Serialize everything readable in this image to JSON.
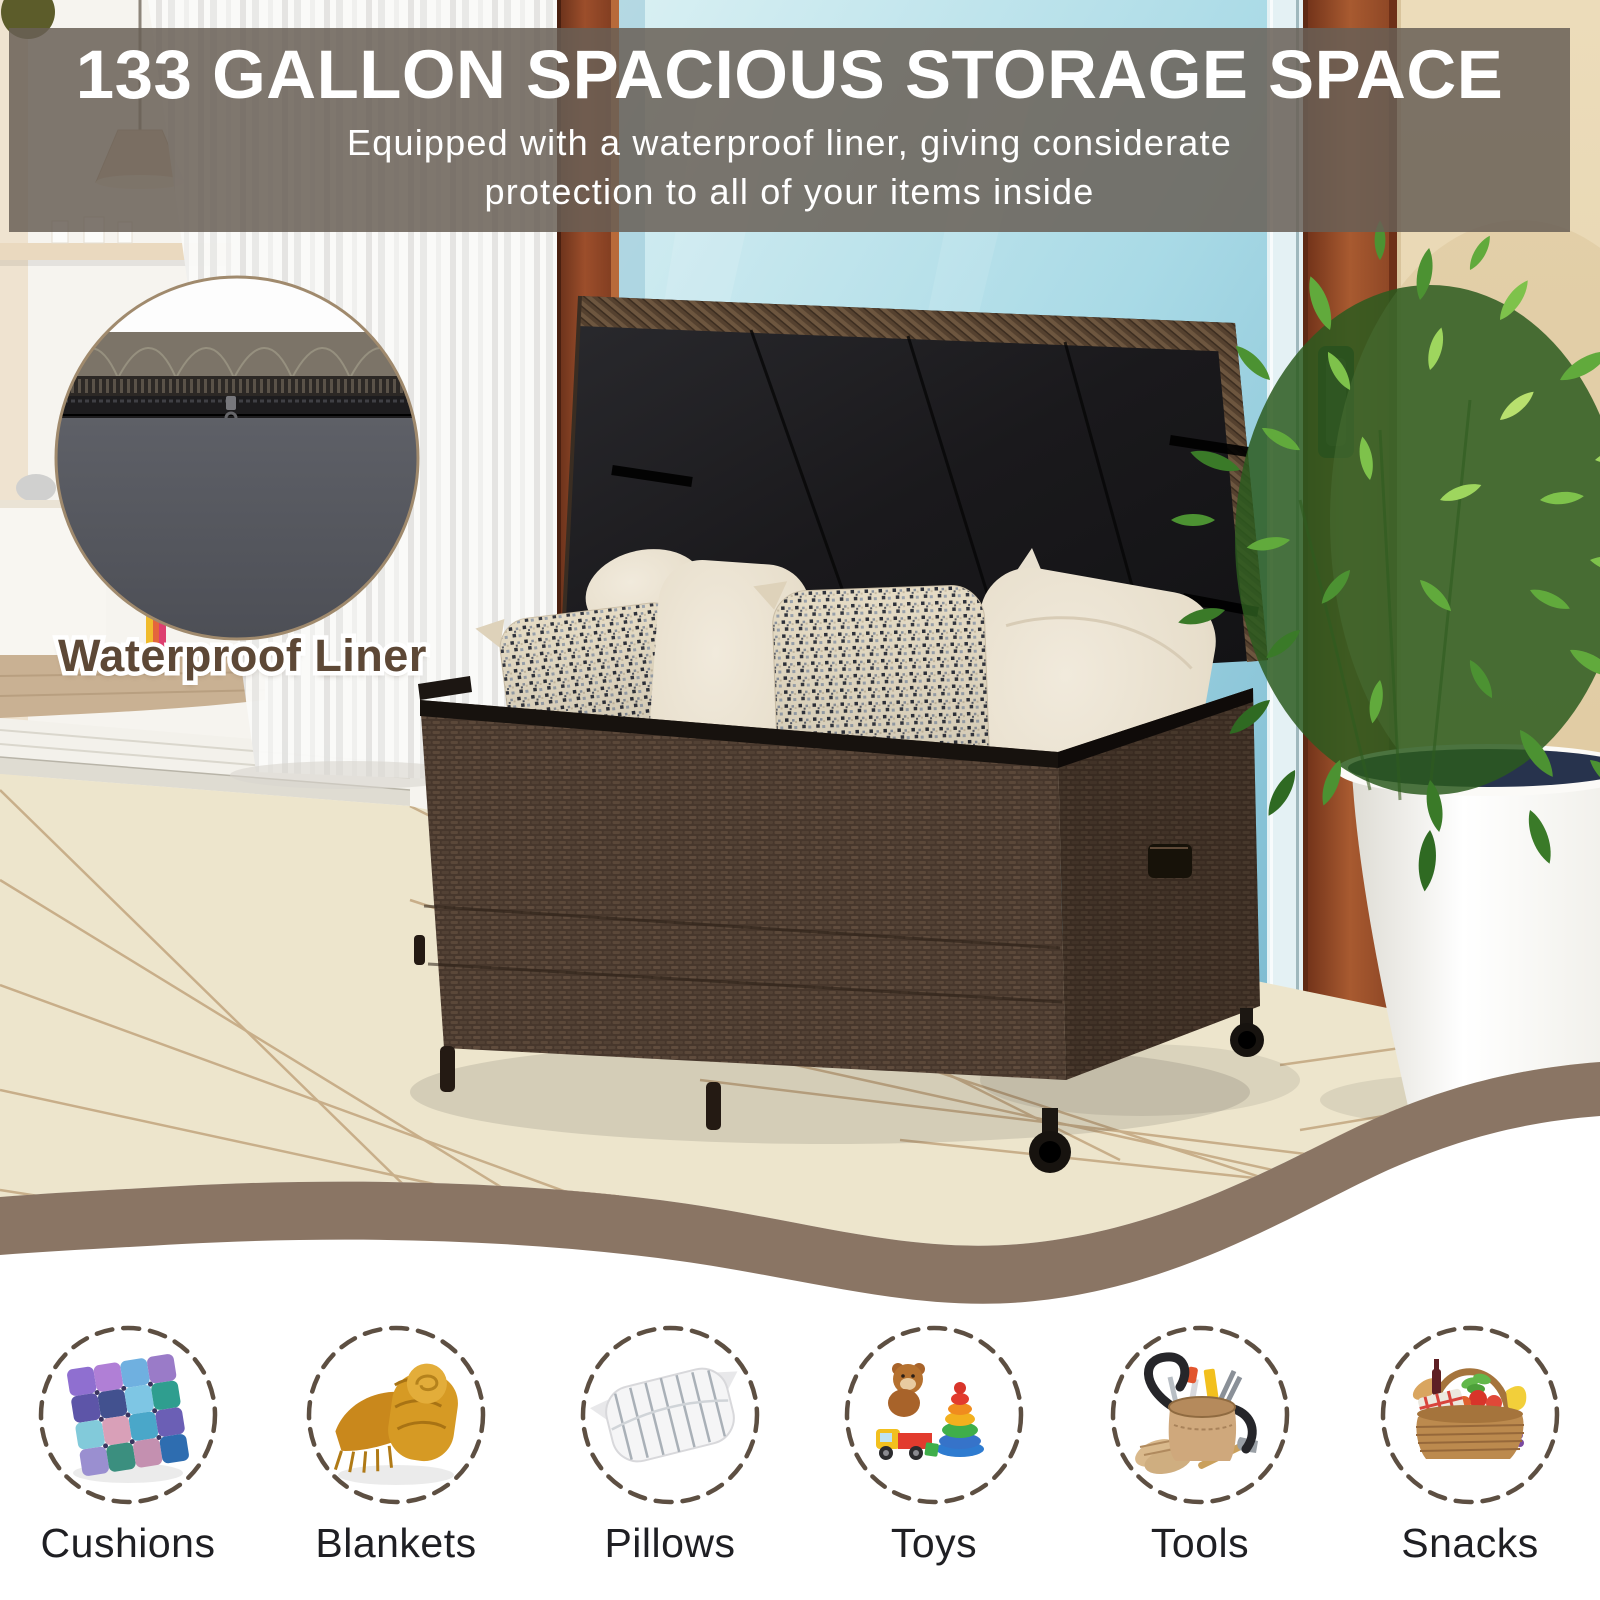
{
  "banner": {
    "title": "133 GALLON SPACIOUS STORAGE SPACE",
    "subtitle_line1": "Equipped with a waterproof liner, giving considerate",
    "subtitle_line2": "protection to all of your items inside"
  },
  "inset": {
    "label": "Waterproof Liner"
  },
  "features": {
    "items": [
      {
        "label": "Cushions",
        "icon": "cushion-icon"
      },
      {
        "label": "Blankets",
        "icon": "blanket-icon"
      },
      {
        "label": "Pillows",
        "icon": "pillow-icon"
      },
      {
        "label": "Toys",
        "icon": "toys-icon"
      },
      {
        "label": "Tools",
        "icon": "tools-icon"
      },
      {
        "label": "Snacks",
        "icon": "snacks-icon"
      }
    ]
  },
  "colors": {
    "banner_overlay": "rgba(104,95,86,0.85)",
    "wave": "#8a7564",
    "dashed_circle": "#5d4f42",
    "label_text": "#1f1f23",
    "inset_label": "#5d4836",
    "wicker_brown": "#4a392e",
    "deck_cream": "#ede5cc",
    "glass_blue": "#a9dae6",
    "wall_tan": "#ead9b4"
  }
}
